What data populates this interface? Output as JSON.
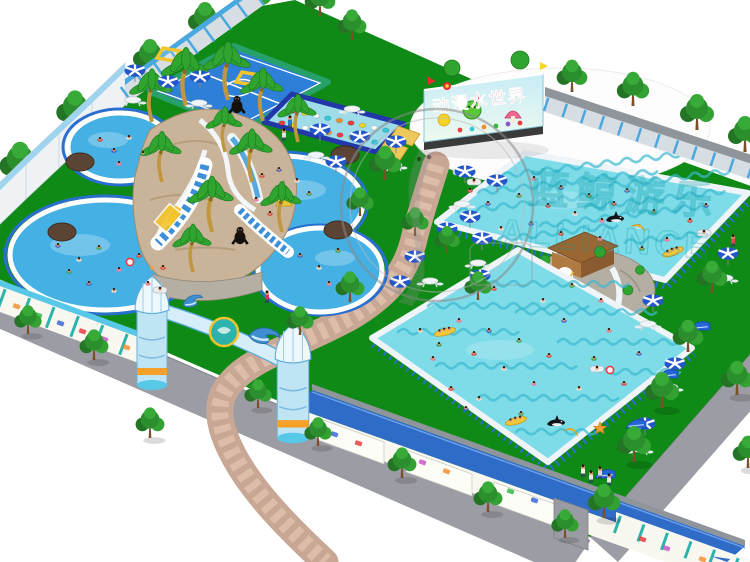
{
  "scene_title": "Aerial 3D render of an inflatable water park",
  "billboard": {
    "text": "动漫水世界"
  },
  "watermark": {
    "cn": "蓝鲸游乐",
    "en": "ALLIANCE"
  },
  "palette": {
    "grass": "#0f8a16",
    "pool_water": "#45b0e4",
    "frame_pool_water": "#7edce9",
    "frame_pool_pattern": "#3cb9cf",
    "pool_ring_blue": "#2a6fd0",
    "path_brick": "#c9a795",
    "path_brick_light": "#dcbda8",
    "sidewalk": "#9c9ca4",
    "wall_white": "#eef2f5",
    "fence_blue": "#4aa8e0",
    "fence_panel": "#d7dee3",
    "banner_teal": "#2db3ac",
    "banner_white": "#f8f7f0",
    "roof_blue": "#2e6cc8",
    "stone_tan": "#c9b49a",
    "stone_gray": "#b5aea2",
    "tree_green": "#2c8f2e",
    "palm_green": "#2fa42f",
    "trunk_brown": "#7a4f2a",
    "palm_trunk": "#c0973f",
    "umbrella_blue": "#2356c8",
    "skin": "#e5a077",
    "sun_yellow": "#f3c52c",
    "orange": "#f09a28",
    "red": "#e23030",
    "soccer_blue": "#2e7fd8",
    "soccer_border": "#28a06a",
    "watermark_teal": "#0a9aa6"
  },
  "objects": {
    "trees_back": [
      [
        20,
        185,
        1.2
      ],
      [
        75,
        130,
        1.1
      ],
      [
        150,
        75,
        1.0
      ],
      [
        205,
        38,
        1.0
      ],
      [
        255,
        12,
        0.95
      ]
    ],
    "trees_ne": [
      [
        320,
        16,
        0.9
      ],
      [
        352,
        40,
        0.85
      ],
      [
        572,
        92,
        0.9
      ],
      [
        633,
        106,
        0.95
      ],
      [
        697,
        130,
        1.0
      ],
      [
        745,
        152,
        1.0
      ]
    ],
    "trees_inner": [
      [
        385,
        180,
        0.95
      ],
      [
        360,
        216,
        0.8
      ],
      [
        415,
        236,
        0.8
      ],
      [
        447,
        253,
        0.75
      ],
      [
        478,
        300,
        0.8
      ],
      [
        350,
        302,
        0.85
      ],
      [
        300,
        335,
        0.8
      ],
      [
        712,
        293,
        0.9
      ],
      [
        688,
        352,
        0.9
      ]
    ],
    "trees_road": [
      [
        28,
        334,
        0.8
      ],
      [
        94,
        360,
        0.85
      ],
      [
        150,
        438,
        0.85
      ],
      [
        258,
        408,
        0.8
      ],
      [
        318,
        446,
        0.8
      ],
      [
        402,
        478,
        0.85
      ],
      [
        488,
        512,
        0.85
      ],
      [
        565,
        538,
        0.8
      ],
      [
        662,
        408,
        1.0
      ],
      [
        634,
        462,
        1.0
      ],
      [
        604,
        518,
        0.95
      ],
      [
        737,
        395,
        0.95
      ],
      [
        748,
        468,
        0.9
      ]
    ],
    "palms": [
      [
        152,
        122,
        1
      ],
      [
        186,
        106,
        1.1
      ],
      [
        228,
        100,
        1.1
      ],
      [
        263,
        121,
        1
      ],
      [
        298,
        142,
        0.9
      ],
      [
        162,
        182,
        0.95
      ],
      [
        252,
        182,
        1.0
      ],
      [
        212,
        232,
        1.05
      ],
      [
        282,
        232,
        0.95
      ],
      [
        193,
        272,
        0.9
      ],
      [
        225,
        152,
        0.85
      ]
    ],
    "rocks": [
      [
        80,
        162
      ],
      [
        62,
        232
      ],
      [
        345,
        155
      ],
      [
        338,
        230
      ]
    ],
    "gorillas": [
      [
        237,
        112
      ],
      [
        240,
        243
      ]
    ],
    "umbrellas": [
      [
        135,
        82
      ],
      [
        168,
        93
      ],
      [
        200,
        88
      ],
      [
        320,
        141
      ],
      [
        360,
        148
      ],
      [
        396,
        153
      ],
      [
        336,
        173
      ],
      [
        465,
        183
      ],
      [
        497,
        192
      ],
      [
        470,
        228
      ],
      [
        447,
        240
      ],
      [
        482,
        250
      ],
      [
        415,
        268
      ],
      [
        400,
        293
      ],
      [
        480,
        287
      ],
      [
        728,
        265
      ],
      [
        653,
        312
      ],
      [
        675,
        375
      ],
      [
        645,
        435
      ]
    ],
    "tables": [
      [
        133,
        103
      ],
      [
        199,
        106
      ],
      [
        352,
        112
      ],
      [
        316,
        158
      ],
      [
        394,
        168
      ],
      [
        462,
        207
      ],
      [
        478,
        266
      ],
      [
        430,
        284
      ],
      [
        725,
        281
      ],
      [
        648,
        327
      ],
      [
        670,
        390
      ],
      [
        640,
        452
      ]
    ],
    "loungers": [
      [
        700,
        330
      ],
      [
        668,
        378
      ],
      [
        636,
        428
      ],
      [
        605,
        478
      ]
    ],
    "people": [
      [
        290,
        126,
        "#2878c8"
      ],
      [
        284,
        139,
        "#e0e0e0"
      ],
      [
        267,
        301,
        "#d83060"
      ],
      [
        583,
        475,
        "#f0f0f0"
      ],
      [
        591,
        481,
        "#e8e8e8"
      ],
      [
        600,
        477,
        "#d8d8d8"
      ],
      [
        609,
        484,
        "#e8e8e8"
      ],
      [
        733,
        245,
        "#d05050"
      ]
    ],
    "swim_colors": [
      "#d83838",
      "#3858c8",
      "#f0e8e0",
      "#28a048",
      "#e878b0"
    ],
    "stepping_stone_colors": [
      "#e84040",
      "#f5d327",
      "#fafafa",
      "#35c8d8",
      "#f09030"
    ],
    "banner_colors": [
      "#f09030",
      "#35b848",
      "#3868d8",
      "#e84040",
      "#c858c8"
    ],
    "swimmers": {
      "pool_a": [
        [
          100,
          140
        ],
        [
          114,
          151
        ],
        [
          129,
          138
        ],
        [
          143,
          154
        ],
        [
          119,
          164
        ]
      ],
      "pool_b": [
        [
          262,
          176
        ],
        [
          279,
          170
        ],
        [
          297,
          181
        ],
        [
          309,
          194
        ],
        [
          256,
          200
        ],
        [
          270,
          214
        ]
      ],
      "pool_c": [
        [
          58,
          246
        ],
        [
          79,
          260
        ],
        [
          99,
          248
        ],
        [
          119,
          270
        ],
        [
          139,
          256
        ],
        [
          89,
          284
        ],
        [
          114,
          291
        ],
        [
          69,
          272
        ],
        [
          148,
          284
        ],
        [
          163,
          268
        ]
      ],
      "pool_d": [
        [
          300,
          256
        ],
        [
          319,
          268
        ],
        [
          338,
          251
        ],
        [
          329,
          284
        ]
      ],
      "pool_tr": [
        [
          470,
          191
        ],
        [
          488,
          204
        ],
        [
          504,
          183
        ],
        [
          519,
          196
        ],
        [
          534,
          179
        ],
        [
          548,
          206
        ],
        [
          561,
          188
        ],
        [
          575,
          214
        ],
        [
          589,
          196
        ],
        [
          602,
          221
        ],
        [
          614,
          204
        ],
        [
          627,
          191
        ],
        [
          639,
          227
        ],
        [
          654,
          212
        ],
        [
          600,
          239
        ],
        [
          561,
          234
        ],
        [
          531,
          224
        ],
        [
          501,
          229
        ],
        [
          642,
          249
        ],
        [
          667,
          240
        ],
        [
          690,
          221
        ],
        [
          706,
          206
        ]
      ],
      "pool_br": [
        [
          420,
          331
        ],
        [
          439,
          345
        ],
        [
          459,
          321
        ],
        [
          474,
          354
        ],
        [
          489,
          331
        ],
        [
          504,
          369
        ],
        [
          519,
          341
        ],
        [
          534,
          384
        ],
        [
          549,
          356
        ],
        [
          564,
          321
        ],
        [
          579,
          389
        ],
        [
          594,
          359
        ],
        [
          609,
          331
        ],
        [
          624,
          384
        ],
        [
          639,
          354
        ],
        [
          479,
          399
        ],
        [
          521,
          414
        ],
        [
          433,
          359
        ],
        [
          451,
          389
        ],
        [
          466,
          409
        ],
        [
          543,
          301
        ],
        [
          572,
          286
        ],
        [
          601,
          301
        ],
        [
          494,
          289
        ]
      ]
    },
    "floats": [
      {
        "type": "raft",
        "x": 460,
        "y": 172
      },
      {
        "type": "raft",
        "x": 474,
        "y": 182
      },
      {
        "type": "orca",
        "x": 615,
        "y": 220
      },
      {
        "type": "banana",
        "x": 638,
        "y": 229
      },
      {
        "type": "banana_boat",
        "x": 673,
        "y": 252,
        "r": -20
      },
      {
        "type": "raft",
        "x": 704,
        "y": 233
      },
      {
        "type": "banana_boat",
        "x": 445,
        "y": 332,
        "r": -15
      },
      {
        "type": "banana_boat",
        "x": 516,
        "y": 421,
        "r": -15
      },
      {
        "type": "orca",
        "x": 556,
        "y": 424
      },
      {
        "type": "banana",
        "x": 571,
        "y": 433
      },
      {
        "type": "star",
        "x": 600,
        "y": 428
      },
      {
        "type": "raft",
        "x": 597,
        "y": 369
      },
      {
        "type": "raft",
        "x": 160,
        "y": 290
      },
      {
        "type": "ring",
        "x": 130,
        "y": 262
      },
      {
        "type": "ring",
        "x": 610,
        "y": 370
      }
    ]
  }
}
